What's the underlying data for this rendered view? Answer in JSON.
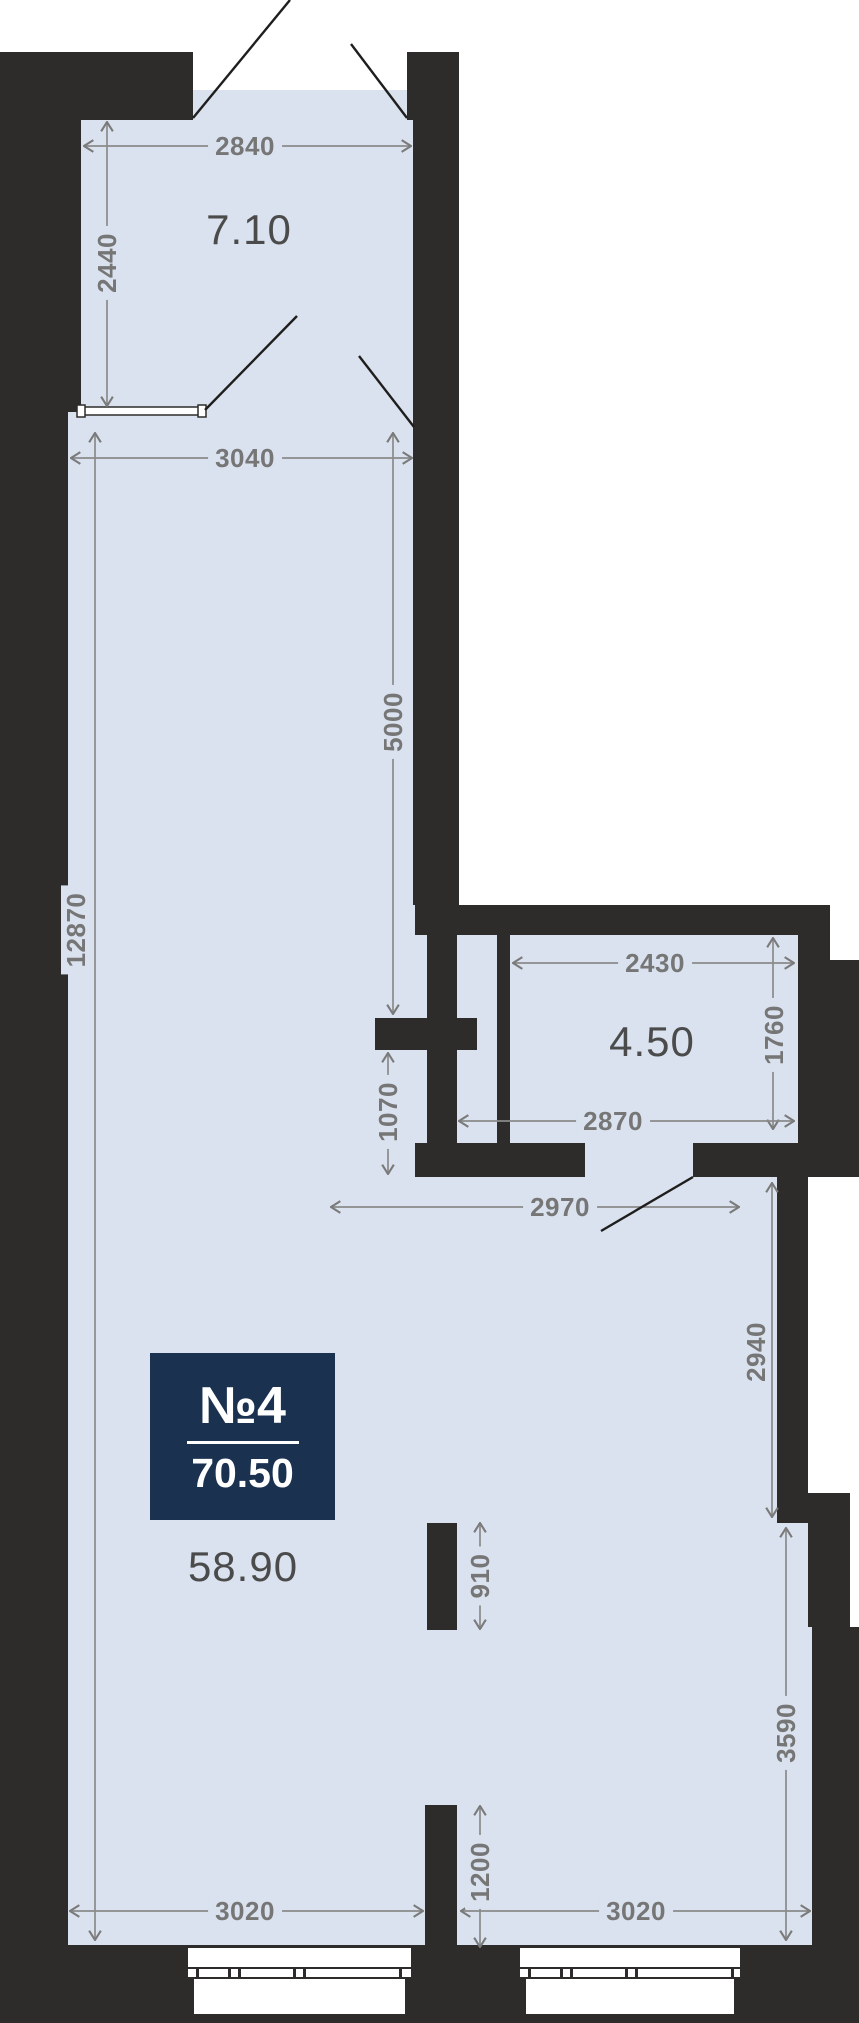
{
  "unit_badge": {
    "number": "№4",
    "total_area": "70.50"
  },
  "area_labels": {
    "balcony": "7.10",
    "bathroom": "4.50",
    "living": "58.90"
  },
  "dims": {
    "d2840": "2840",
    "d2440": "2440",
    "d3040": "3040",
    "d5000": "5000",
    "d12870": "12870",
    "d2430": "2430",
    "d1760": "1760",
    "d2870": "2870",
    "d1070": "1070",
    "d2970": "2970",
    "d2940": "2940",
    "d910": "910",
    "d3590": "3590",
    "d1200": "1200",
    "d3020_left": "3020",
    "d3020_right": "3020"
  },
  "colors": {
    "wall": "#2d2c2b",
    "room_fill": "#d9e2ee",
    "dim_text": "#767676",
    "area_text": "#4b4b4b",
    "badge_bg": "#1a3150",
    "badge_text": "#ffffff"
  }
}
